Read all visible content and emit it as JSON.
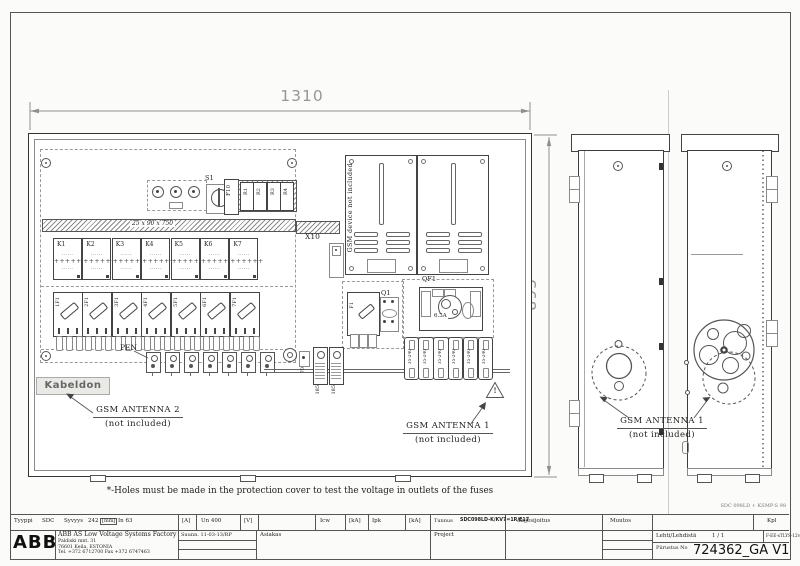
{
  "dims": {
    "width": "1310",
    "height": "895"
  },
  "doc_ref": "SDC 098LD + KSMP-S 98",
  "note": "*-Holes  must  be  made  in  the  protection  cover  to  test  the  voltage  in  outlets  of  the  fuses",
  "front": {
    "s1": "S1",
    "f10": "F10",
    "relays": [
      "R1",
      "R2",
      "R3",
      "R4"
    ],
    "busbar": "25 x 90 x 750",
    "contactors": [
      "K1",
      "K2",
      "K3",
      "K4",
      "K5",
      "K6",
      "K7"
    ],
    "k_dots": "······",
    "k_plus": "++++++",
    "fuses": [
      "1F1",
      "2F1",
      "3F1",
      "4F1",
      "5F1",
      "6F1",
      "7F1"
    ],
    "pen": "PEN",
    "brand": "Kabeldon",
    "x10": "X10",
    "gsm_device": "GSM device not included",
    "q1": "Q1",
    "q1_fuse": "F1",
    "qf1": "QF1",
    "qf1_rating": "6.3A",
    "blocks": [
      "35-240",
      "35-240",
      "35-240",
      "35-240",
      "35-240",
      "35-240"
    ],
    "lugs": [
      "185",
      "185"
    ],
    "bar70": "70",
    "warning": "!"
  },
  "callouts": {
    "ant2_l1": "GSM ANTENNA 2",
    "ant2_l2": "(not  included)",
    "ant1f_l1": "GSM ANTENNA 1",
    "ant1f_l2": "(not  included)",
    "ant1s_l1": "GSM ANTENNA 1",
    "ant1s_l2": "(not  included)"
  },
  "tb": {
    "tyyppi": "Tyyppi",
    "tyyppi_v": "SDC",
    "syvyys": "Syvyys",
    "syvyys_v": "242",
    "mm": "[mm]",
    "in_v": "In  63",
    "a": "[A]",
    "un_v": "Un  400",
    "v": "[V]",
    "icw": "Icw",
    "ka1": "[kA]",
    "ipk": "Ipk",
    "ka2": "[kA]",
    "tunnus": "Tunnus",
    "tunnus_v": "SDC098LD-K/KV7=1R/E17",
    "koje": "Kojesijoitus",
    "muutos": "Muutos",
    "kpl": "Kpl",
    "logo": "ABB",
    "company": "ABB AS Low Voltage Systems Factory",
    "addr1": "Paldiski mnt. 31",
    "addr2": "76601 Keila, ESTONIA",
    "addr3": "Tel. +372 6712700   Fax +372 6747463",
    "suunn": "Suunn. 11-03-13/RP",
    "asiakas": "Asiakas",
    "project": "Project",
    "lehti": "Lehti/Lehdistä",
    "lehti_v": "1  /  1",
    "form": "F-EE-sTLYS-12v01",
    "piirustus": "Piirustus No",
    "drawing_no": "724362_GA V1"
  }
}
